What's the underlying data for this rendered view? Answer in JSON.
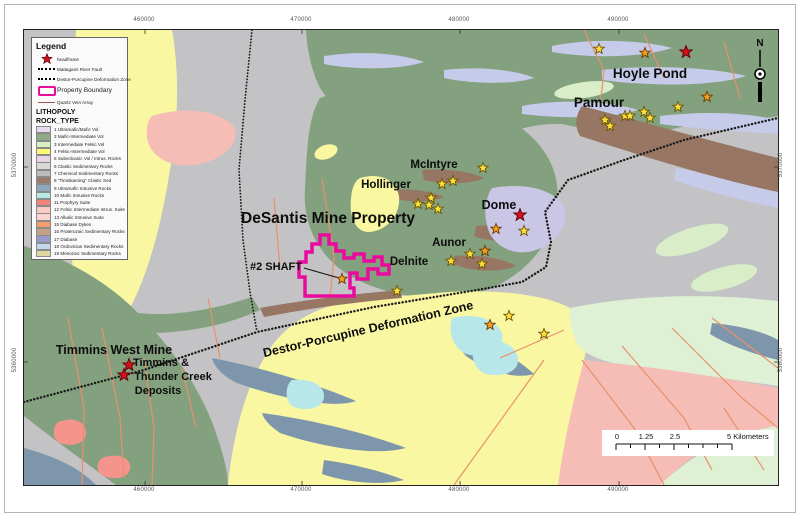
{
  "legend": {
    "title": "Legend",
    "symbols": [
      {
        "type": "red-star",
        "label": "headframe"
      },
      {
        "type": "dotted-line",
        "label": "Mattagami River Fault"
      },
      {
        "type": "dotted-line-heavy",
        "label": "Destor-Porcupine Deformation Zone"
      },
      {
        "type": "magenta-box",
        "label": "Property Boundary"
      },
      {
        "type": "dark-red-line",
        "label": "Quartz Vein Array"
      }
    ],
    "lithopoly_title": "LITHOPOLY",
    "rock_type_title": "ROCK_TYPE",
    "rock_types": [
      {
        "id": 1,
        "label": "Ultramafic/Mafic Vol",
        "color": "#e7d9ef"
      },
      {
        "id": 2,
        "label": "Mafic-Intermediate Vol",
        "color": "#8cab86"
      },
      {
        "id": 3,
        "label": "Intermediate Felsic Vol",
        "color": "#d9f0c5"
      },
      {
        "id": 4,
        "label": "Felsic-Intermediate Vol",
        "color": "#fbf774"
      },
      {
        "id": 5,
        "label": "Subvolcanic Vol / Intrus. Rocks",
        "color": "#e8d4e4"
      },
      {
        "id": 6,
        "label": "Clastic Sedimentary Rocks",
        "color": "#d8d8d8"
      },
      {
        "id": 7,
        "label": "Chemical Sedimentary Rocks",
        "color": "#bcbcbc"
      },
      {
        "id": 8,
        "label": "\"Timiskaming\" Clastic Sed",
        "color": "#9b7a68"
      },
      {
        "id": 9,
        "label": "Ultramafic Intrusive Rocks",
        "color": "#90a7bb"
      },
      {
        "id": 10,
        "label": "Mafic Intrusive Rocks",
        "color": "#b9e9e5"
      },
      {
        "id": 11,
        "label": "Porphyry Suite",
        "color": "#f4827a"
      },
      {
        "id": 12,
        "label": "Felsic Intermediate Intrus. Suite",
        "color": "#f8cbc4"
      },
      {
        "id": 13,
        "label": "Alkalic Intrusive Suite",
        "color": "#f9d6cf"
      },
      {
        "id": 15,
        "label": "Diabase Dykes",
        "color": "#f59c6d"
      },
      {
        "id": 16,
        "label": "Proterozoic Sedimentary Rocks",
        "color": "#c3a184"
      },
      {
        "id": 17,
        "label": "Diabase",
        "color": "#9a9aca"
      },
      {
        "id": 18,
        "label": "Ordovician Sedimentary Rocks",
        "color": "#c3d8ea"
      },
      {
        "id": 19,
        "label": "Mesozoic Sedimentary Rocks",
        "color": "#ddd8a2"
      }
    ]
  },
  "map": {
    "property_boundary": {
      "name": "DeSantis Mine Property boundary",
      "color": "#ea0b9e"
    },
    "star_colors": {
      "yellow": {
        "fill": "#ffe13d",
        "stroke": "#6b5400"
      },
      "orange": {
        "fill": "#f5a21c",
        "stroke": "#6b3a00"
      },
      "red": {
        "fill": "#d6111e",
        "stroke": "#5a0006"
      }
    },
    "labels": [
      {
        "id": "hoyle-pond",
        "text": "Hoyle Pond",
        "x": 626,
        "y": 48,
        "size": 13.5
      },
      {
        "id": "pamour",
        "text": "Pamour",
        "x": 575,
        "y": 77,
        "size": 13.5
      },
      {
        "id": "mcintyre",
        "text": "McIntyre",
        "x": 410,
        "y": 138,
        "size": 11.5
      },
      {
        "id": "hollinger",
        "text": "Hollinger",
        "x": 362,
        "y": 158,
        "size": 11.5
      },
      {
        "id": "dome",
        "text": "Dome",
        "x": 475,
        "y": 179,
        "size": 12.5
      },
      {
        "id": "aunor",
        "text": "Aunor",
        "x": 425,
        "y": 216,
        "size": 11.5
      },
      {
        "id": "delnite",
        "text": "Delnite",
        "x": 385,
        "y": 235,
        "size": 11.5
      },
      {
        "id": "desantis",
        "text": "DeSantis Mine Property",
        "x": 304,
        "y": 193,
        "size": 15.5
      },
      {
        "id": "shaft",
        "text": "#2 SHAFT",
        "x": 252,
        "y": 240,
        "size": 11
      },
      {
        "id": "dpdz",
        "text": "Destor-Porcupine Deformation Zone",
        "x": 345,
        "y": 303,
        "size": 12.5,
        "rotate": -13
      },
      {
        "id": "timmins-west",
        "text": "Timmins West Mine",
        "x": 90,
        "y": 324,
        "size": 12.5
      },
      {
        "id": "tc-line1",
        "text": "Timmins &",
        "x": 137,
        "y": 336,
        "size": 11
      },
      {
        "id": "tc-line2",
        "text": "Thunder Creek",
        "x": 149,
        "y": 350,
        "size": 11
      },
      {
        "id": "tc-line3",
        "text": "Deposits",
        "x": 134,
        "y": 364,
        "size": 11
      },
      {
        "id": "north",
        "text": "N",
        "x": 736,
        "y": 16,
        "size": 10
      }
    ],
    "stars": [
      {
        "x": 575,
        "y": 19,
        "c": "yellow"
      },
      {
        "x": 621,
        "y": 23,
        "c": "orange"
      },
      {
        "x": 662,
        "y": 22,
        "c": "red"
      },
      {
        "x": 683,
        "y": 67,
        "c": "orange"
      },
      {
        "x": 654,
        "y": 77,
        "c": "yellow"
      },
      {
        "x": 581,
        "y": 90,
        "c": "yellow"
      },
      {
        "x": 586,
        "y": 96,
        "c": "yellow"
      },
      {
        "x": 601,
        "y": 86,
        "c": "yellow"
      },
      {
        "x": 606,
        "y": 86,
        "c": "yellow"
      },
      {
        "x": 620,
        "y": 82,
        "c": "yellow"
      },
      {
        "x": 626,
        "y": 88,
        "c": "yellow"
      },
      {
        "x": 459,
        "y": 138,
        "c": "yellow"
      },
      {
        "x": 429,
        "y": 151,
        "c": "yellow"
      },
      {
        "x": 418,
        "y": 154,
        "c": "yellow"
      },
      {
        "x": 407,
        "y": 168,
        "c": "yellow"
      },
      {
        "x": 394,
        "y": 174,
        "c": "yellow"
      },
      {
        "x": 405,
        "y": 175,
        "c": "yellow"
      },
      {
        "x": 414,
        "y": 179,
        "c": "yellow"
      },
      {
        "x": 496,
        "y": 185,
        "c": "red"
      },
      {
        "x": 472,
        "y": 199,
        "c": "orange"
      },
      {
        "x": 500,
        "y": 201,
        "c": "yellow"
      },
      {
        "x": 461,
        "y": 221,
        "c": "orange"
      },
      {
        "x": 446,
        "y": 224,
        "c": "yellow"
      },
      {
        "x": 427,
        "y": 231,
        "c": "yellow"
      },
      {
        "x": 458,
        "y": 234,
        "c": "yellow"
      },
      {
        "x": 373,
        "y": 261,
        "c": "yellow"
      },
      {
        "x": 318,
        "y": 249,
        "c": "orange"
      },
      {
        "x": 485,
        "y": 286,
        "c": "yellow"
      },
      {
        "x": 466,
        "y": 295,
        "c": "orange"
      },
      {
        "x": 520,
        "y": 304,
        "c": "yellow"
      },
      {
        "x": 105,
        "y": 335,
        "c": "red"
      },
      {
        "x": 100,
        "y": 345,
        "c": "red"
      }
    ]
  },
  "edge_labels": {
    "top": [
      {
        "v": "460000",
        "x": 143
      },
      {
        "v": "470000",
        "x": 300
      },
      {
        "v": "480000",
        "x": 458
      },
      {
        "v": "490000",
        "x": 617
      }
    ],
    "bottom": [
      {
        "v": "460000",
        "x": 143
      },
      {
        "v": "470000",
        "x": 300
      },
      {
        "v": "480000",
        "x": 458
      },
      {
        "v": "490000",
        "x": 617
      }
    ],
    "left": [
      {
        "v": "5370000",
        "y": 165
      },
      {
        "v": "5360000",
        "y": 360
      }
    ],
    "right": [
      {
        "v": "5370000",
        "y": 165
      },
      {
        "v": "5360000",
        "y": 360
      }
    ]
  },
  "scalebar": {
    "labels": [
      "0",
      "1.25",
      "2.5",
      "5 Kilometers"
    ]
  }
}
